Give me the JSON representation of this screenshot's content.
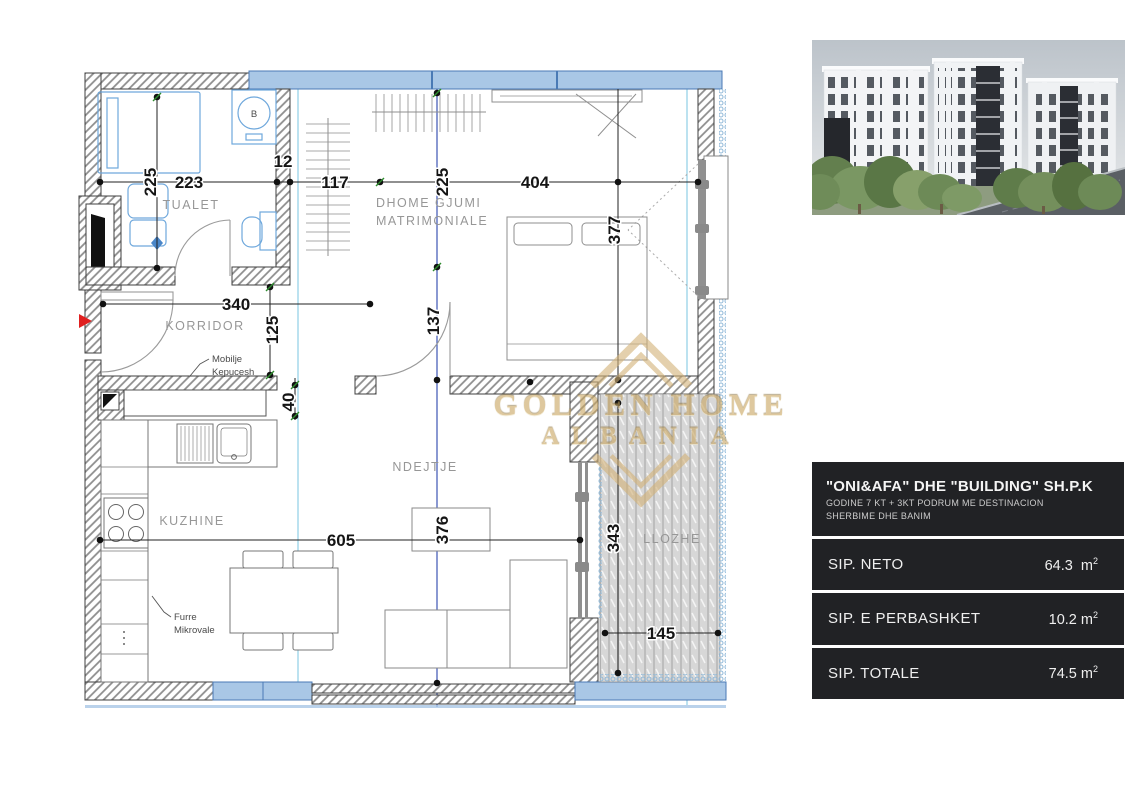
{
  "plan": {
    "rooms": {
      "tualet": "TUALET",
      "bedroom1": "DHOME GJUMI",
      "bedroom2": "MATRIMONIALE",
      "korridor": "KORRIDOR",
      "kuzhine": "KUZHINE",
      "ndejtje": "NDEJTJE",
      "llozhe": "LLOZHE"
    },
    "dims": {
      "d225a": "225",
      "d223": "223",
      "d12": "12",
      "d117": "117",
      "d225b": "225",
      "d404": "404",
      "d377": "377",
      "d340": "340",
      "d125": "125",
      "d137": "137",
      "d40": "40",
      "d605": "605",
      "d376": "376",
      "d343": "343",
      "d145": "145"
    },
    "annotations": {
      "shoe1": "Mobilje",
      "shoe2": "Kepucesh",
      "oven1": "Furre",
      "oven2": "Mikrovale",
      "boiler": "B"
    }
  },
  "watermark": {
    "line1": "GOLDEN HOME",
    "line2": "ALBANIA"
  },
  "panel": {
    "title": "\"ONI&AFA\" DHE \"BUILDING\" SH.P.K",
    "subtitle1": "GODINE 7 KT + 3KT PODRUM ME DESTINACION",
    "subtitle2": "SHERBIME DHE BANIM",
    "rows": [
      {
        "label": "SIP. NETO",
        "value": "64.3",
        "unit": "m",
        "sup": "2"
      },
      {
        "label": "SIP. E PERBASHKET",
        "value": "10.2",
        "unit": "m",
        "sup": "2"
      },
      {
        "label": "SIP. TOTALE",
        "value": "74.5",
        "unit": "m",
        "sup": "2"
      }
    ]
  },
  "colors": {
    "wall_blue": "#a9c7e6",
    "line_blue": "#3c55b4",
    "cyan": "#7ac4e0",
    "gold": "#c9a55f",
    "red_arrow": "#e02020",
    "panel_bg": "#212225"
  }
}
